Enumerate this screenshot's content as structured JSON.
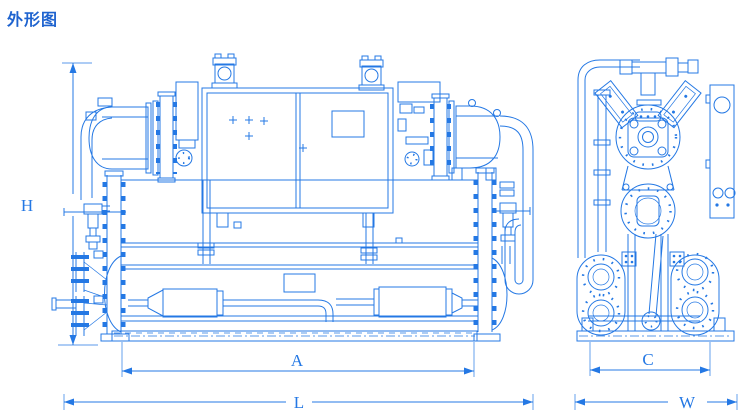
{
  "page": {
    "title": "外形图",
    "background_color": "#ffffff",
    "line_color": "#2478e4",
    "title_color": "#1e63cf"
  },
  "drawing": {
    "type": "technical-outline-drawing",
    "style": "blueprint line drawing of a water-cooled screw chiller, front view and side view",
    "dimensions": {
      "height": {
        "label": "H",
        "orientation": "vertical",
        "view": "front"
      },
      "foot_span_front": {
        "label": "A",
        "orientation": "horizontal",
        "view": "front"
      },
      "overall_length": {
        "label": "L",
        "orientation": "horizontal",
        "view": "front"
      },
      "foot_span_side": {
        "label": "C",
        "orientation": "horizontal",
        "view": "side"
      },
      "overall_width": {
        "label": "W",
        "orientation": "horizontal",
        "view": "side"
      }
    }
  }
}
